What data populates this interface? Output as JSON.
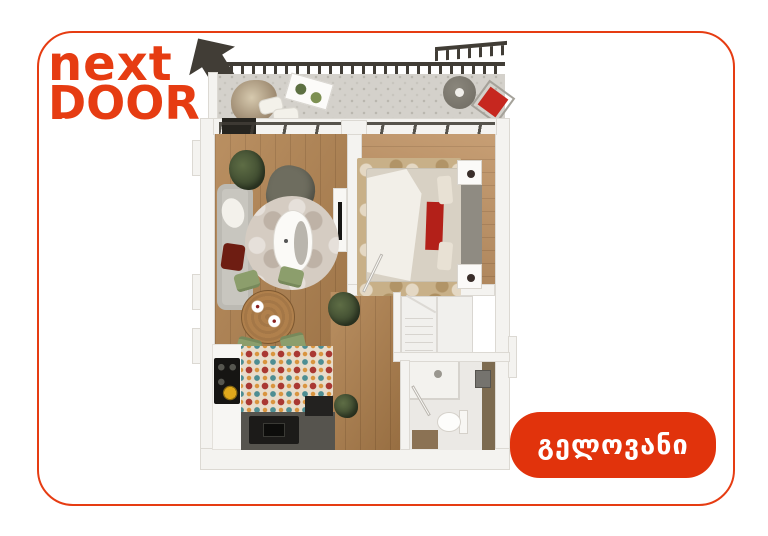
{
  "logo": {
    "line1": "next",
    "line2": "DOOR"
  },
  "badge": {
    "label": "გელოვანი"
  },
  "colors": {
    "accent": "#e63c12",
    "badge-bg": "#e1330c",
    "wall": "#f4f3f0",
    "wall-edge": "#dcd9d3",
    "wood": "#b0804c",
    "wood-light": "#bf9161",
    "balcony-floor": "#d4d1cb",
    "dark-frame": "#413d36",
    "sofa": "#c8c6bf",
    "rug-round": "#d5ccc2",
    "rug-bed": "#c8b088",
    "bedding": "#d8d1c4",
    "duvet": "#f2efe8",
    "red-accent": "#b32019",
    "dark-red": "#6e1d12",
    "green-chair": "#8c9e6c",
    "olive-chair": "#6e6d5f",
    "island": "#56544e",
    "mosaic-base": "#e8dcca",
    "mosaic-red": "#a93832",
    "mosaic-teal": "#4e8e93",
    "mosaic-orange": "#d9953f",
    "bath-floor": "#ebe9e5",
    "vanity": "#7d6b50",
    "chair-red": "#c6271f",
    "stairs": "#f1f0ed",
    "panel-gray": "#8f8b82"
  }
}
